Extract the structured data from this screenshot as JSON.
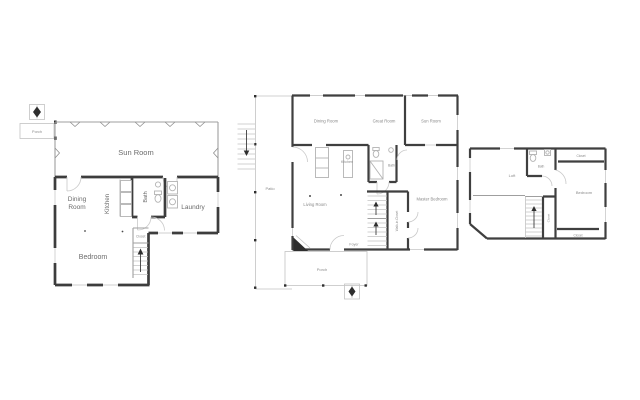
{
  "page": {
    "type": "real-estate floor plan sheet",
    "background": "#ffffff"
  },
  "colors": {
    "wall": "#3d3d3d",
    "thin_line": "#c3c3c3",
    "fixture_line": "#b3b3b3",
    "label_text": "#6b6b6b",
    "north_arrow": "#2e2e2e"
  },
  "plans": {
    "left": {
      "porch": "Porch",
      "sun_room": "Sun Room",
      "dining_line1": "Dining",
      "dining_line2": "Room",
      "kitchen": "Kitchen",
      "bath": "Bath",
      "laundry": "Laundry",
      "bedroom": "Bedroom",
      "closet": "Closet"
    },
    "middle": {
      "patio": "Patio",
      "dining_room": "Dining Room",
      "great_room": "Great Room",
      "sun_room": "Sun Room",
      "kitchen": "Kitchen",
      "bath": "Bath",
      "living_room": "Living Room",
      "master_bedroom": "Master Bedroom",
      "walk_in_closet": "Walk-in Closet",
      "foyer": "Foyer",
      "porch": "Porch"
    },
    "right": {
      "loft": "Loft",
      "bath": "Bath",
      "closet_top": "Closet",
      "bedroom": "Bedroom",
      "closet_middle": "Closet",
      "closet_bottom": "Closet"
    }
  }
}
